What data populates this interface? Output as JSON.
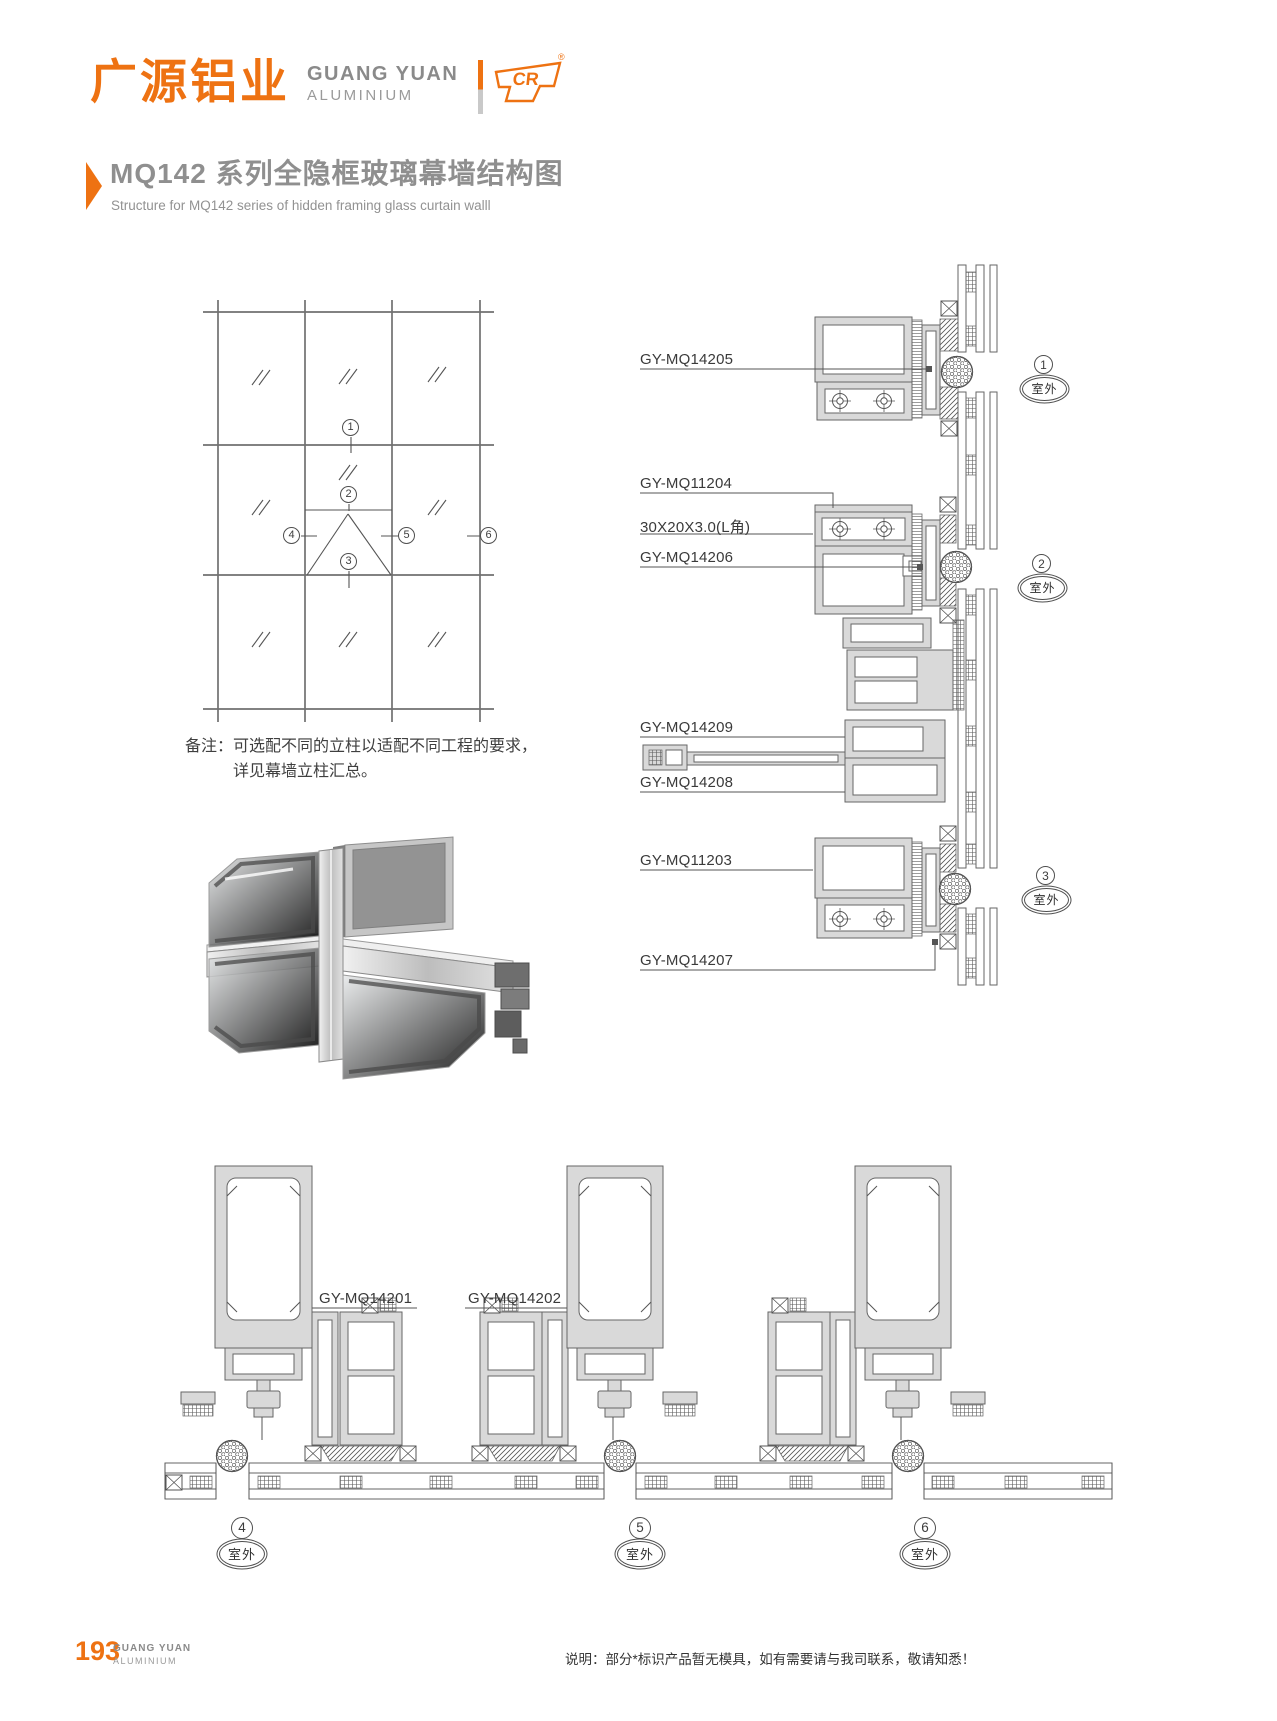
{
  "brand": {
    "name_cn": "广源铝业",
    "name_en_line1": "GUANG YUAN",
    "name_en_line2": "ALUMINIUM",
    "mark_text": "CR",
    "registered_mark": "®"
  },
  "title": {
    "cn": "MQ142 系列全隐框玻璃幕墙结构图",
    "en": "Structure for MQ142 series of hidden framing glass curtain walll"
  },
  "note": {
    "label": "备注：",
    "line1": "可选配不同的立柱以适配不同工程的要求，",
    "line2": "详见幕墙立柱汇总。"
  },
  "elevation": {
    "markers": [
      {
        "num": "1"
      },
      {
        "num": "2"
      },
      {
        "num": "3"
      },
      {
        "num": "4"
      },
      {
        "num": "5"
      },
      {
        "num": "6"
      }
    ]
  },
  "vertical_section": {
    "labels": [
      {
        "text": "GY-MQ14205"
      },
      {
        "text": "GY-MQ11204"
      },
      {
        "text": "30X20X3.0(L角)"
      },
      {
        "text": "GY-MQ14206"
      },
      {
        "text": "GY-MQ14209"
      },
      {
        "text": "GY-MQ14208"
      },
      {
        "text": "GY-MQ11203"
      },
      {
        "text": "GY-MQ14207"
      }
    ],
    "markers": [
      {
        "num": "1",
        "location": "室外"
      },
      {
        "num": "2",
        "location": "室外"
      },
      {
        "num": "3",
        "location": "室外"
      }
    ]
  },
  "horizontal_section": {
    "labels": [
      {
        "text": "GY-MQ14201"
      },
      {
        "text": "GY-MQ14202"
      }
    ],
    "markers": [
      {
        "num": "4",
        "location": "室外"
      },
      {
        "num": "5",
        "location": "室外"
      },
      {
        "num": "6",
        "location": "室外"
      }
    ]
  },
  "footer": {
    "page_number": "193",
    "brand_en_line1": "GUANG YUAN",
    "brand_en_line2": "ALUMINIUM",
    "note": "说明：部分*标识产品暂无模具，如有需要请与我司联系，敬请知悉！"
  },
  "colors": {
    "accent": "#EE7212",
    "title_gray": "#8F8F8F",
    "drawing_line": "#666666"
  }
}
